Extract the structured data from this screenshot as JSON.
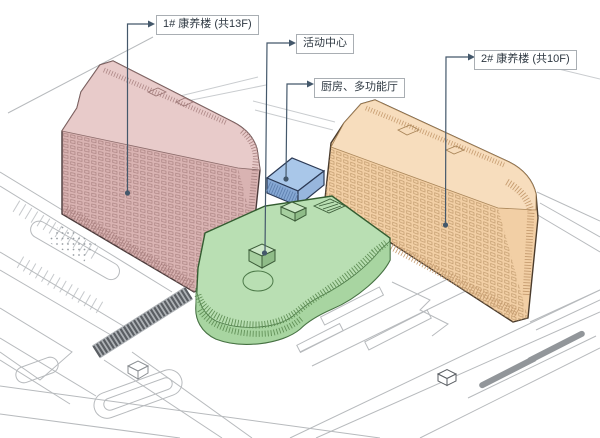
{
  "labels": {
    "building1": {
      "text": "1# 康养楼 (共13F)"
    },
    "activity_center": {
      "text": "活动中心"
    },
    "kitchen_hall": {
      "text": "厨房、多功能厅"
    },
    "building2": {
      "text": "2# 康养楼 (共10F)"
    }
  },
  "colors": {
    "building1_fill": "#d9b3b2",
    "building1_roof": "#e8cbca",
    "building2_fill": "#f2cfa5",
    "building2_roof": "#f7ddbd",
    "activity_center_roof": "#b9dfb3",
    "activity_center_facade": "#a8d5a1",
    "kitchen_hall_top": "#a9c7e9",
    "kitchen_hall_front": "#86a8d4",
    "kitchen_hall_side": "#97b6dd",
    "leader": "#44586b",
    "site_line": "#b7babd",
    "label_border": "#a9aeb3",
    "label_text": "#2e3842"
  }
}
